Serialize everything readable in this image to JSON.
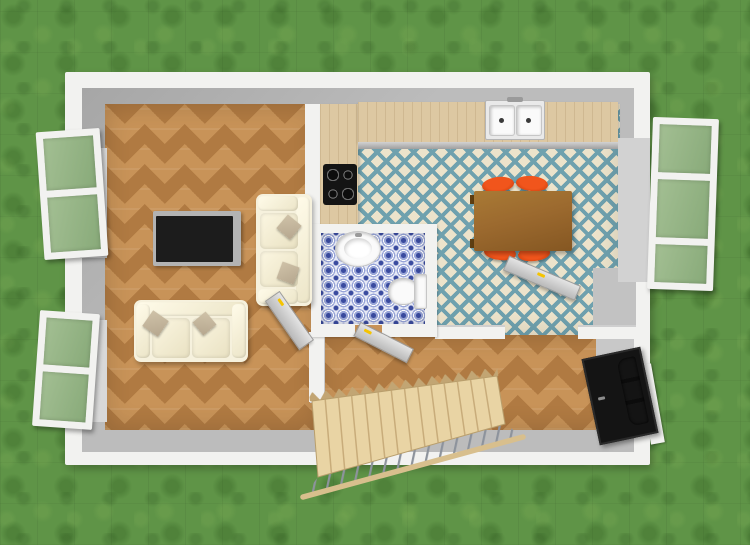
{
  "canvas": {
    "width": 750,
    "height": 545
  },
  "scene_type": "aerial-3d-floor-plan-render",
  "rooms": [
    {
      "name": "living-room",
      "floor": "chevron-parquet"
    },
    {
      "name": "kitchen-dining",
      "floor": "teal-diamond-tile"
    },
    {
      "name": "bathroom",
      "floor": "blue-mosaic-tile"
    },
    {
      "name": "hallway",
      "floor": "chevron-parquet"
    }
  ],
  "furniture": [
    {
      "name": "tv",
      "room": "living-room"
    },
    {
      "name": "tv-console",
      "room": "living-room"
    },
    {
      "name": "sofa-east",
      "room": "living-room",
      "pillows": 2
    },
    {
      "name": "sofa-south",
      "room": "living-room",
      "pillows": 2
    },
    {
      "name": "dining-table",
      "room": "kitchen-dining",
      "chairs": 4
    },
    {
      "name": "kitchen-counter",
      "room": "kitchen-dining",
      "features": [
        "double-sink",
        "cooktop-4-burner"
      ]
    },
    {
      "name": "washbasin",
      "room": "bathroom"
    },
    {
      "name": "toilet",
      "room": "bathroom"
    },
    {
      "name": "staircase",
      "steps": 14,
      "railing": true
    }
  ],
  "doors": [
    {
      "name": "front-door",
      "style": "black-glazed",
      "state": "open"
    },
    {
      "name": "living-room-door",
      "state": "open",
      "handle": "yellow"
    },
    {
      "name": "bathroom-door",
      "state": "open",
      "handle": "yellow"
    },
    {
      "name": "kitchen-door",
      "state": "open",
      "handle": "yellow"
    }
  ],
  "windows": [
    {
      "name": "window-west-north",
      "panes": 2,
      "state": "open"
    },
    {
      "name": "window-west-south",
      "panes": 2,
      "state": "open"
    },
    {
      "name": "window-east",
      "panes": 3,
      "state": "open"
    }
  ],
  "labels": {
    "tv": "Television",
    "tv-console": "TV console",
    "sofa-east": "Two-seat sofa",
    "sofa-south": "Two-seat sofa",
    "dining-table": "Dining table with four chairs",
    "chair": "Dining chair",
    "cooktop": "Four-burner cooktop",
    "sink": "Double kitchen sink",
    "washbasin": "Washbasin",
    "toilet": "Toilet",
    "staircase": "Wooden staircase with railing",
    "front-door": "Front entrance door",
    "interior-door": "Interior door",
    "window": "Open casement window"
  },
  "palette": {
    "grass": "#5f9447",
    "wall-white": "#f2f2f0",
    "wall-gray": "#bcbcbc",
    "wall-gray-dark": "#a6a6a6",
    "wood": "#c89358",
    "wood-dark": "#b07a42",
    "counter": "#ddc8a2",
    "tile-cream": "#ece3cb",
    "tile-teal": "#6fa1ae",
    "bath-base": "#e6e9f5",
    "bath-blue": "#3a4b9f",
    "bath-blue-mid": "#98a5d8",
    "table-wood": "#9c6a2f",
    "chair-orange": "#e84a10",
    "sofa": "#f6f1dd",
    "pillow": "#b6a78f",
    "tv": "#1c1c1c",
    "stair-wood": "#e9d4a4",
    "stair-edge": "#c2a573",
    "rail-wood": "#d8bf8d",
    "baluster": "#8d939c",
    "handle": "#f5c400",
    "front-door": "#141414",
    "door-glass": "#35582a",
    "fixture-white": "#fafafa"
  }
}
